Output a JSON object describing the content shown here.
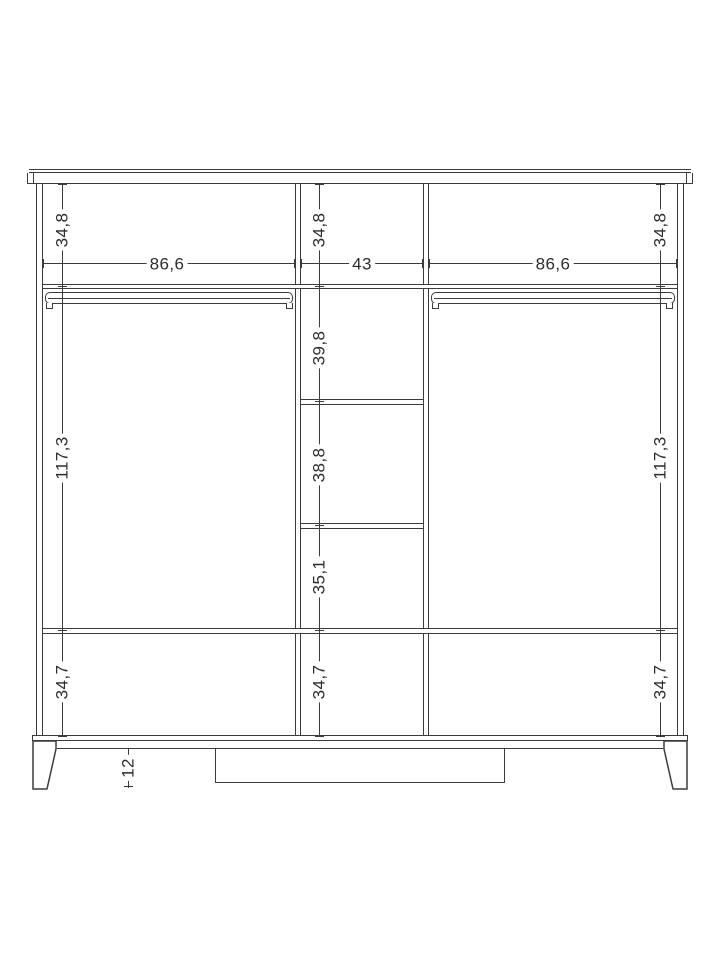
{
  "colors": {
    "line": "#3c3c3c",
    "dimension_line": "#3c3c3c",
    "text": "#2d2d2d",
    "background": "#ffffff"
  },
  "drawing": {
    "dims": {
      "top_left": "34,8",
      "top_center": "34,8",
      "top_right": "34,8",
      "inner_width_left": "86,6",
      "inner_width_center": "43",
      "inner_width_right": "86,6",
      "center_shelf_1": "39,8",
      "left_height": "117,3",
      "right_height": "117,3",
      "center_shelf_2": "38,8",
      "center_shelf_3": "35,1",
      "bottom_left": "34,7",
      "bottom_center": "34,7",
      "bottom_right": "34,7",
      "leg_height": "12"
    }
  }
}
